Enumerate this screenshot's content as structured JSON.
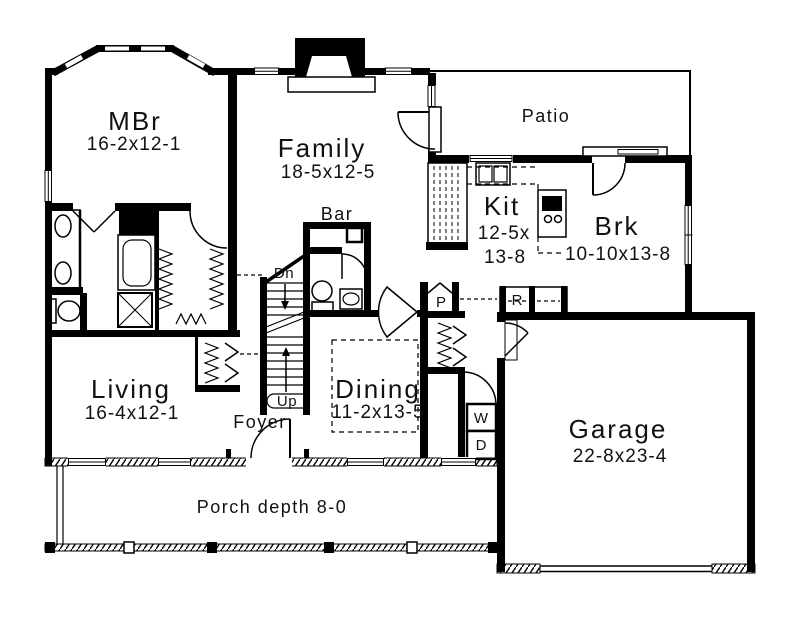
{
  "plan": {
    "title": "First floor plan",
    "rooms": {
      "mbr": {
        "name": "MBr",
        "dims": "16-2x12-1"
      },
      "family": {
        "name": "Family",
        "dims": "18-5x12-5"
      },
      "living": {
        "name": "Living",
        "dims": "16-4x12-1"
      },
      "dining": {
        "name": "Dining",
        "dims": "11-2x13-5"
      },
      "kitchen": {
        "name": "Kit",
        "dims_line1": "12-5x",
        "dims_line2": "13-8"
      },
      "breakfast": {
        "name": "Brk",
        "dims": "10-10x13-8"
      },
      "garage": {
        "name": "Garage",
        "dims": "22-8x23-4"
      },
      "patio": {
        "name": "Patio"
      },
      "bar": {
        "name": "Bar"
      },
      "foyer": {
        "name": "Foyer"
      },
      "porch": {
        "name": "Porch depth 8-0"
      }
    },
    "stairs": {
      "down_label": "Dn",
      "up_label": "Up"
    },
    "appliances": {
      "pantry": "P",
      "refrigerator": "R",
      "washer": "W",
      "dryer": "D"
    },
    "colors": {
      "wall": "#000000",
      "background": "#ffffff"
    }
  }
}
